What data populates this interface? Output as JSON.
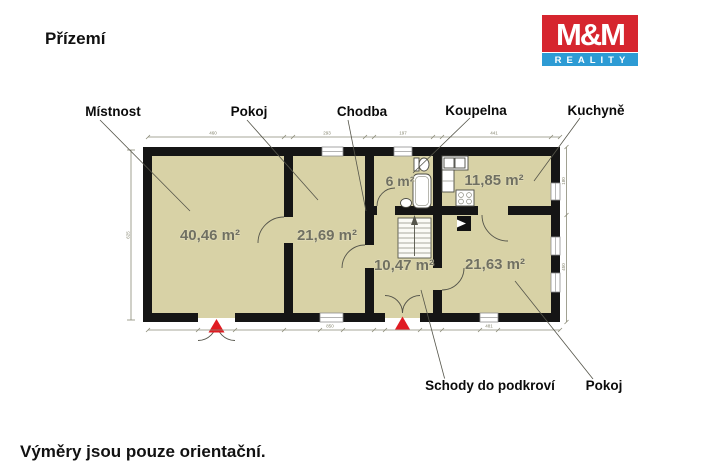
{
  "page": {
    "title": "Přízemí",
    "footer": "Výměry jsou pouze orientační."
  },
  "logo": {
    "line1": "M&M",
    "line2": "REALITY",
    "red": "#d6252e",
    "blue": "#2d9bd4"
  },
  "labels": {
    "mistnost": "Místnost",
    "pokoj_top": "Pokoj",
    "chodba": "Chodba",
    "koupelna": "Koupelna",
    "kuchyne": "Kuchyně",
    "schody": "Schody do podkroví",
    "pokoj_bottom": "Pokoj"
  },
  "areas": {
    "mistnost": "40,46 m²",
    "pokoj_top": "21,69 m²",
    "koupelna": "6 m²",
    "kuchyne": "11,85 m²",
    "chodba": "10,47 m²",
    "pokoj_bottom": "21,63 m²"
  },
  "dimensions": {
    "top": [
      "460",
      "293",
      "197",
      "441"
    ],
    "bottom": [
      "850",
      "481"
    ],
    "left": [
      "625"
    ],
    "right": [
      "180",
      "450"
    ]
  },
  "colors": {
    "floor": "#d8d2a6",
    "wall": "#151515",
    "marker_red": "#e01b22",
    "dimension": "#8a8a76"
  }
}
